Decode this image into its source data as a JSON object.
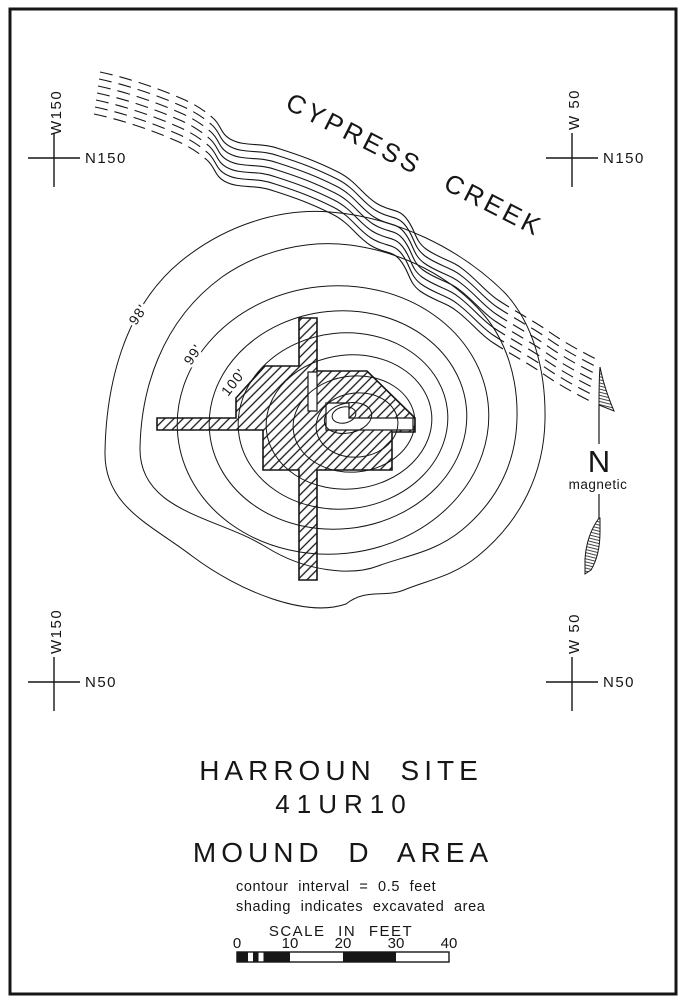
{
  "colors": {
    "paper": "#ffffff",
    "ink": "#161616"
  },
  "creek": {
    "label": "CYPRESS CREEK"
  },
  "grid_markers": [
    {
      "id": "nw",
      "w": "W150",
      "n": "N150"
    },
    {
      "id": "ne",
      "w": "W 50",
      "n": "N150"
    },
    {
      "id": "sw",
      "w": "W150",
      "n": "N50"
    },
    {
      "id": "se",
      "w": "W 50",
      "n": "N50"
    }
  ],
  "contours": {
    "labels": [
      "98'",
      "99'",
      "100'"
    ]
  },
  "north_arrow": {
    "label": "N",
    "sublabel": "magnetic"
  },
  "legend": {
    "title1": "HARROUN SITE",
    "title2": "41UR10",
    "title3": "MOUND D AREA",
    "note1": "contour interval = 0.5 feet",
    "note2": "shading indicates excavated area"
  },
  "scale_bar": {
    "title": "SCALE IN FEET",
    "ticks": [
      "0",
      "10",
      "20",
      "30",
      "40"
    ]
  }
}
